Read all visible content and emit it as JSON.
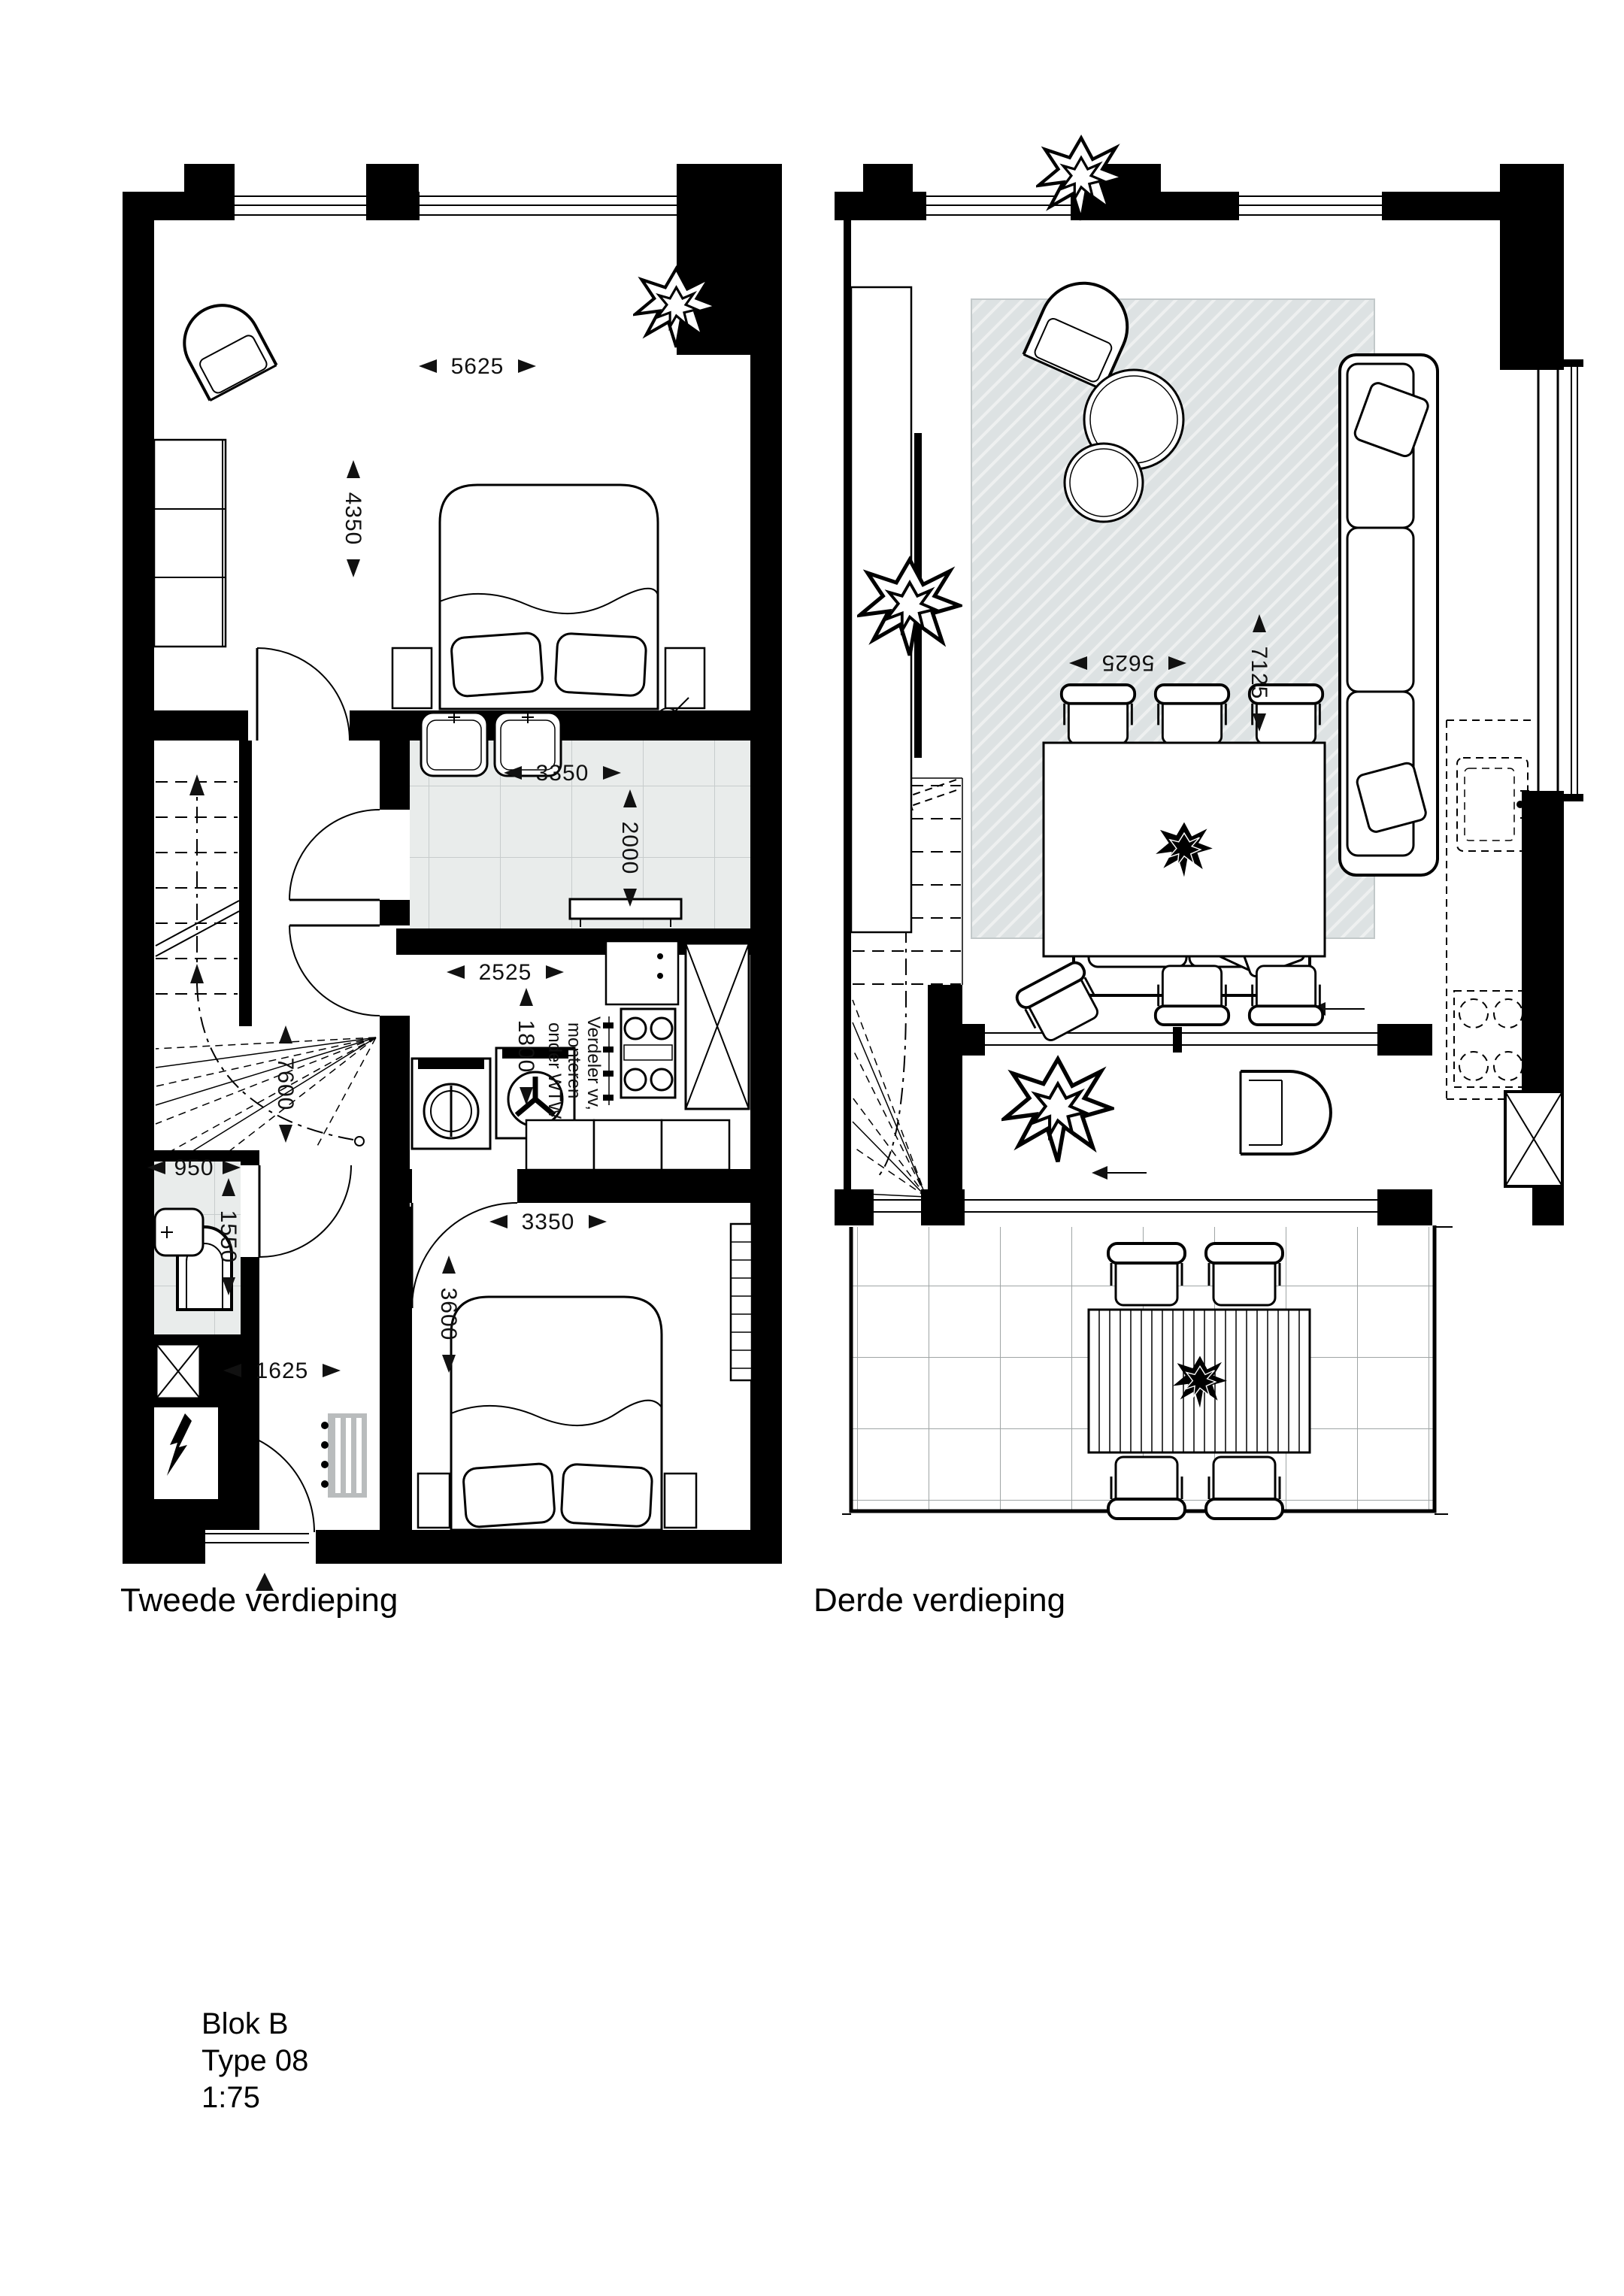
{
  "page": {
    "background": "#ffffff"
  },
  "colors": {
    "wall": "#000000",
    "tile_floor": "#e9eceb",
    "tile_line": "#c7cccc",
    "terrace_line": "#9fa5a5",
    "rug": "#dde2e3",
    "rug_hatch": "#eef0f0",
    "radiator": "#b9bcbd"
  },
  "plans": {
    "tweede": {
      "label": "Tweede verdieping",
      "dims": {
        "bedroom1_width": "5625",
        "bedroom1_depth": "4350",
        "bathroom_width": "3350",
        "bathroom_depth": "2000",
        "kitchen_width": "2525",
        "kitchen_depth": "1800",
        "stairwell_depth": "7600",
        "wc_width": "950",
        "wc_depth": "1550",
        "hall_width": "1625",
        "bedroom2_width": "3350",
        "bedroom2_depth": "3600"
      },
      "kitchen_note": [
        "Verdeler vv,",
        "monteren",
        "onder WTW"
      ]
    },
    "derde": {
      "label": "Derde verdieping",
      "dims": {
        "living_width": "5625",
        "living_depth": "7125"
      }
    }
  },
  "title_block": {
    "block": "Blok B",
    "type": "Type 08",
    "scale": "1:75"
  }
}
